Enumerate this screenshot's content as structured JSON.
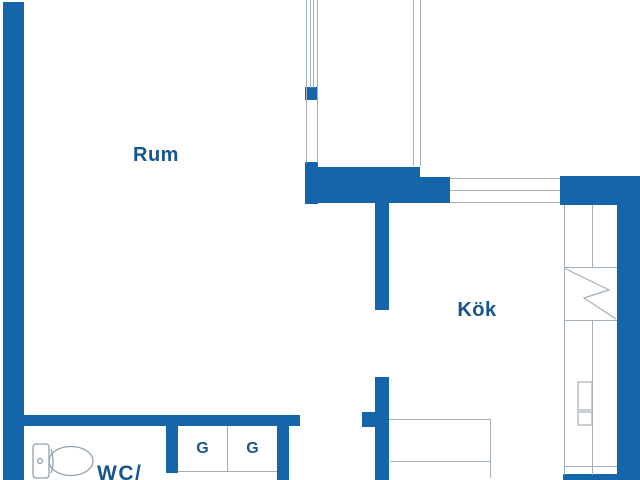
{
  "title": "Apartment floor plan",
  "labels": {
    "room": "Rum",
    "kitchen": "Kök",
    "wc": "WC/",
    "closet_left": "G",
    "closet_right": "G"
  },
  "colors": {
    "wall": "#1565ab",
    "label": "#175590",
    "line": "#a3afb9",
    "fixture": "#8fa0ac",
    "bg": "#ffffff"
  },
  "icons": {
    "toilet": "toilet-icon",
    "stove": "lightning-zigzag-icon"
  }
}
